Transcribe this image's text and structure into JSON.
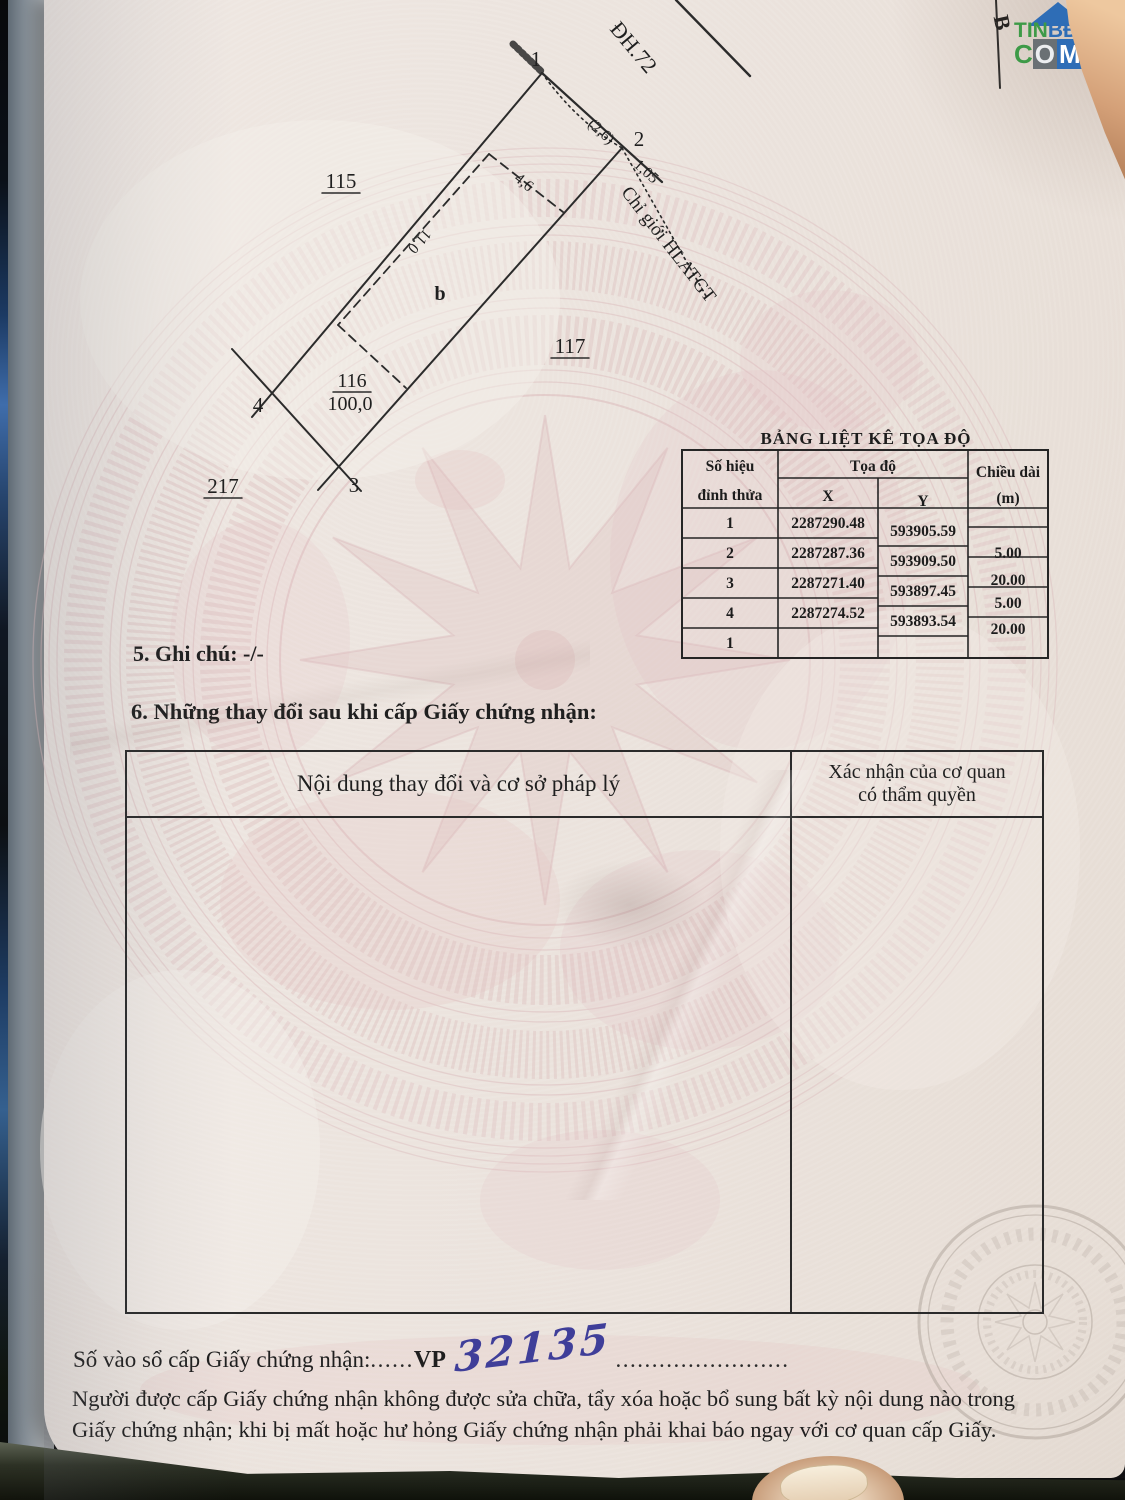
{
  "branding": {
    "part1": "TIN",
    "part2": "BĐS",
    "c": "C",
    "o": "O",
    "m": "M"
  },
  "marker_b": "B",
  "diagram": {
    "road": "ĐH.72",
    "corridor": "Chỉ giới HLATGT",
    "parcel_left": "115",
    "parcel_right": "117",
    "parcel_bottom": "217",
    "parcel": "116",
    "area": "100,0",
    "sub_label": "b",
    "v1": "1",
    "v2": "2",
    "v3": "3",
    "v4": "4",
    "dim_26": "(2,6)",
    "dim_105": "1,05",
    "dim_46": "4,6",
    "dim_110": "11,0"
  },
  "coord_table": {
    "title": "BẢNG LIỆT KÊ TỌA ĐỘ",
    "col_vertex_l1": "Số hiệu",
    "col_vertex_l2": "đỉnh thửa",
    "col_coord": "Tọa độ",
    "col_x": "X",
    "col_y": "Y",
    "col_len_l1": "Chiều dài",
    "col_len_l2": "(m)",
    "rows": [
      {
        "v": "1",
        "x": "2287290.48",
        "y": "593905.59",
        "len": ""
      },
      {
        "v": "2",
        "x": "2287287.36",
        "y": "593909.50",
        "len": "5.00"
      },
      {
        "v": "3",
        "x": "2287271.40",
        "y": "593897.45",
        "len": "20.00"
      },
      {
        "v": "4",
        "x": "2287274.52",
        "y": "593893.54",
        "len": "5.00"
      },
      {
        "v": "1",
        "x": "",
        "y": "",
        "len": "20.00"
      }
    ]
  },
  "section5": "5. Ghi chú: -/-",
  "section6": {
    "heading": "6. Những thay đổi sau khi cấp Giấy chứng nhận:",
    "col1": "Nội dung thay đổi và cơ sở pháp lý",
    "col2_line1": "Xác nhận của cơ quan",
    "col2_line2": "có thẩm quyền"
  },
  "footer": {
    "serial_label": "Số vào sổ cấp Giấy chứng nhận:",
    "dots1": "......",
    "serial_prefix": "VP",
    "serial_value": "32135",
    "dots2": "........................",
    "note1": "Người được cấp Giấy chứng nhận không được sửa chữa, tẩy xóa hoặc bổ sung bất kỳ nội dung nào trong",
    "note2": "Giấy chứng nhận; khi bị mất hoặc hư hỏng Giấy chứng nhận phải khai báo ngay với cơ quan cấp Giấy."
  }
}
